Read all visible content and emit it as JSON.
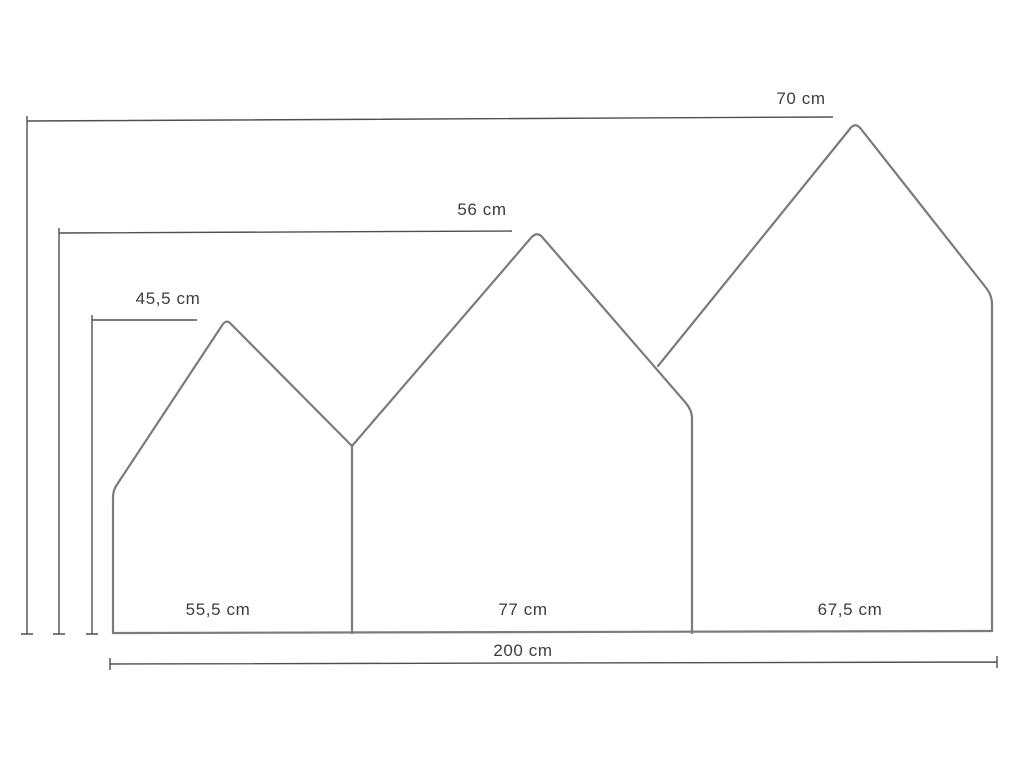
{
  "diagram": {
    "name": "house-shaped-headboard-dimension-drawing",
    "unit": "cm",
    "background_color": "#ffffff",
    "outline_color": "#7b7b7b",
    "dimension_line_color": "#4f4f4f",
    "text_color": "#3d3d3d",
    "total_width_cm": 200,
    "total_width_label": "200 cm",
    "panels": [
      {
        "name": "left-house",
        "width_cm": 55.5,
        "height_cm": 45.5,
        "width_label": "55,5 cm",
        "height_label": "45,5 cm"
      },
      {
        "name": "middle-house",
        "width_cm": 77,
        "height_cm": 56,
        "width_label": "77 cm",
        "height_label": "56 cm"
      },
      {
        "name": "right-house",
        "width_cm": 67.5,
        "height_cm": 70,
        "width_label": "67,5 cm",
        "height_label": "70 cm"
      }
    ]
  }
}
